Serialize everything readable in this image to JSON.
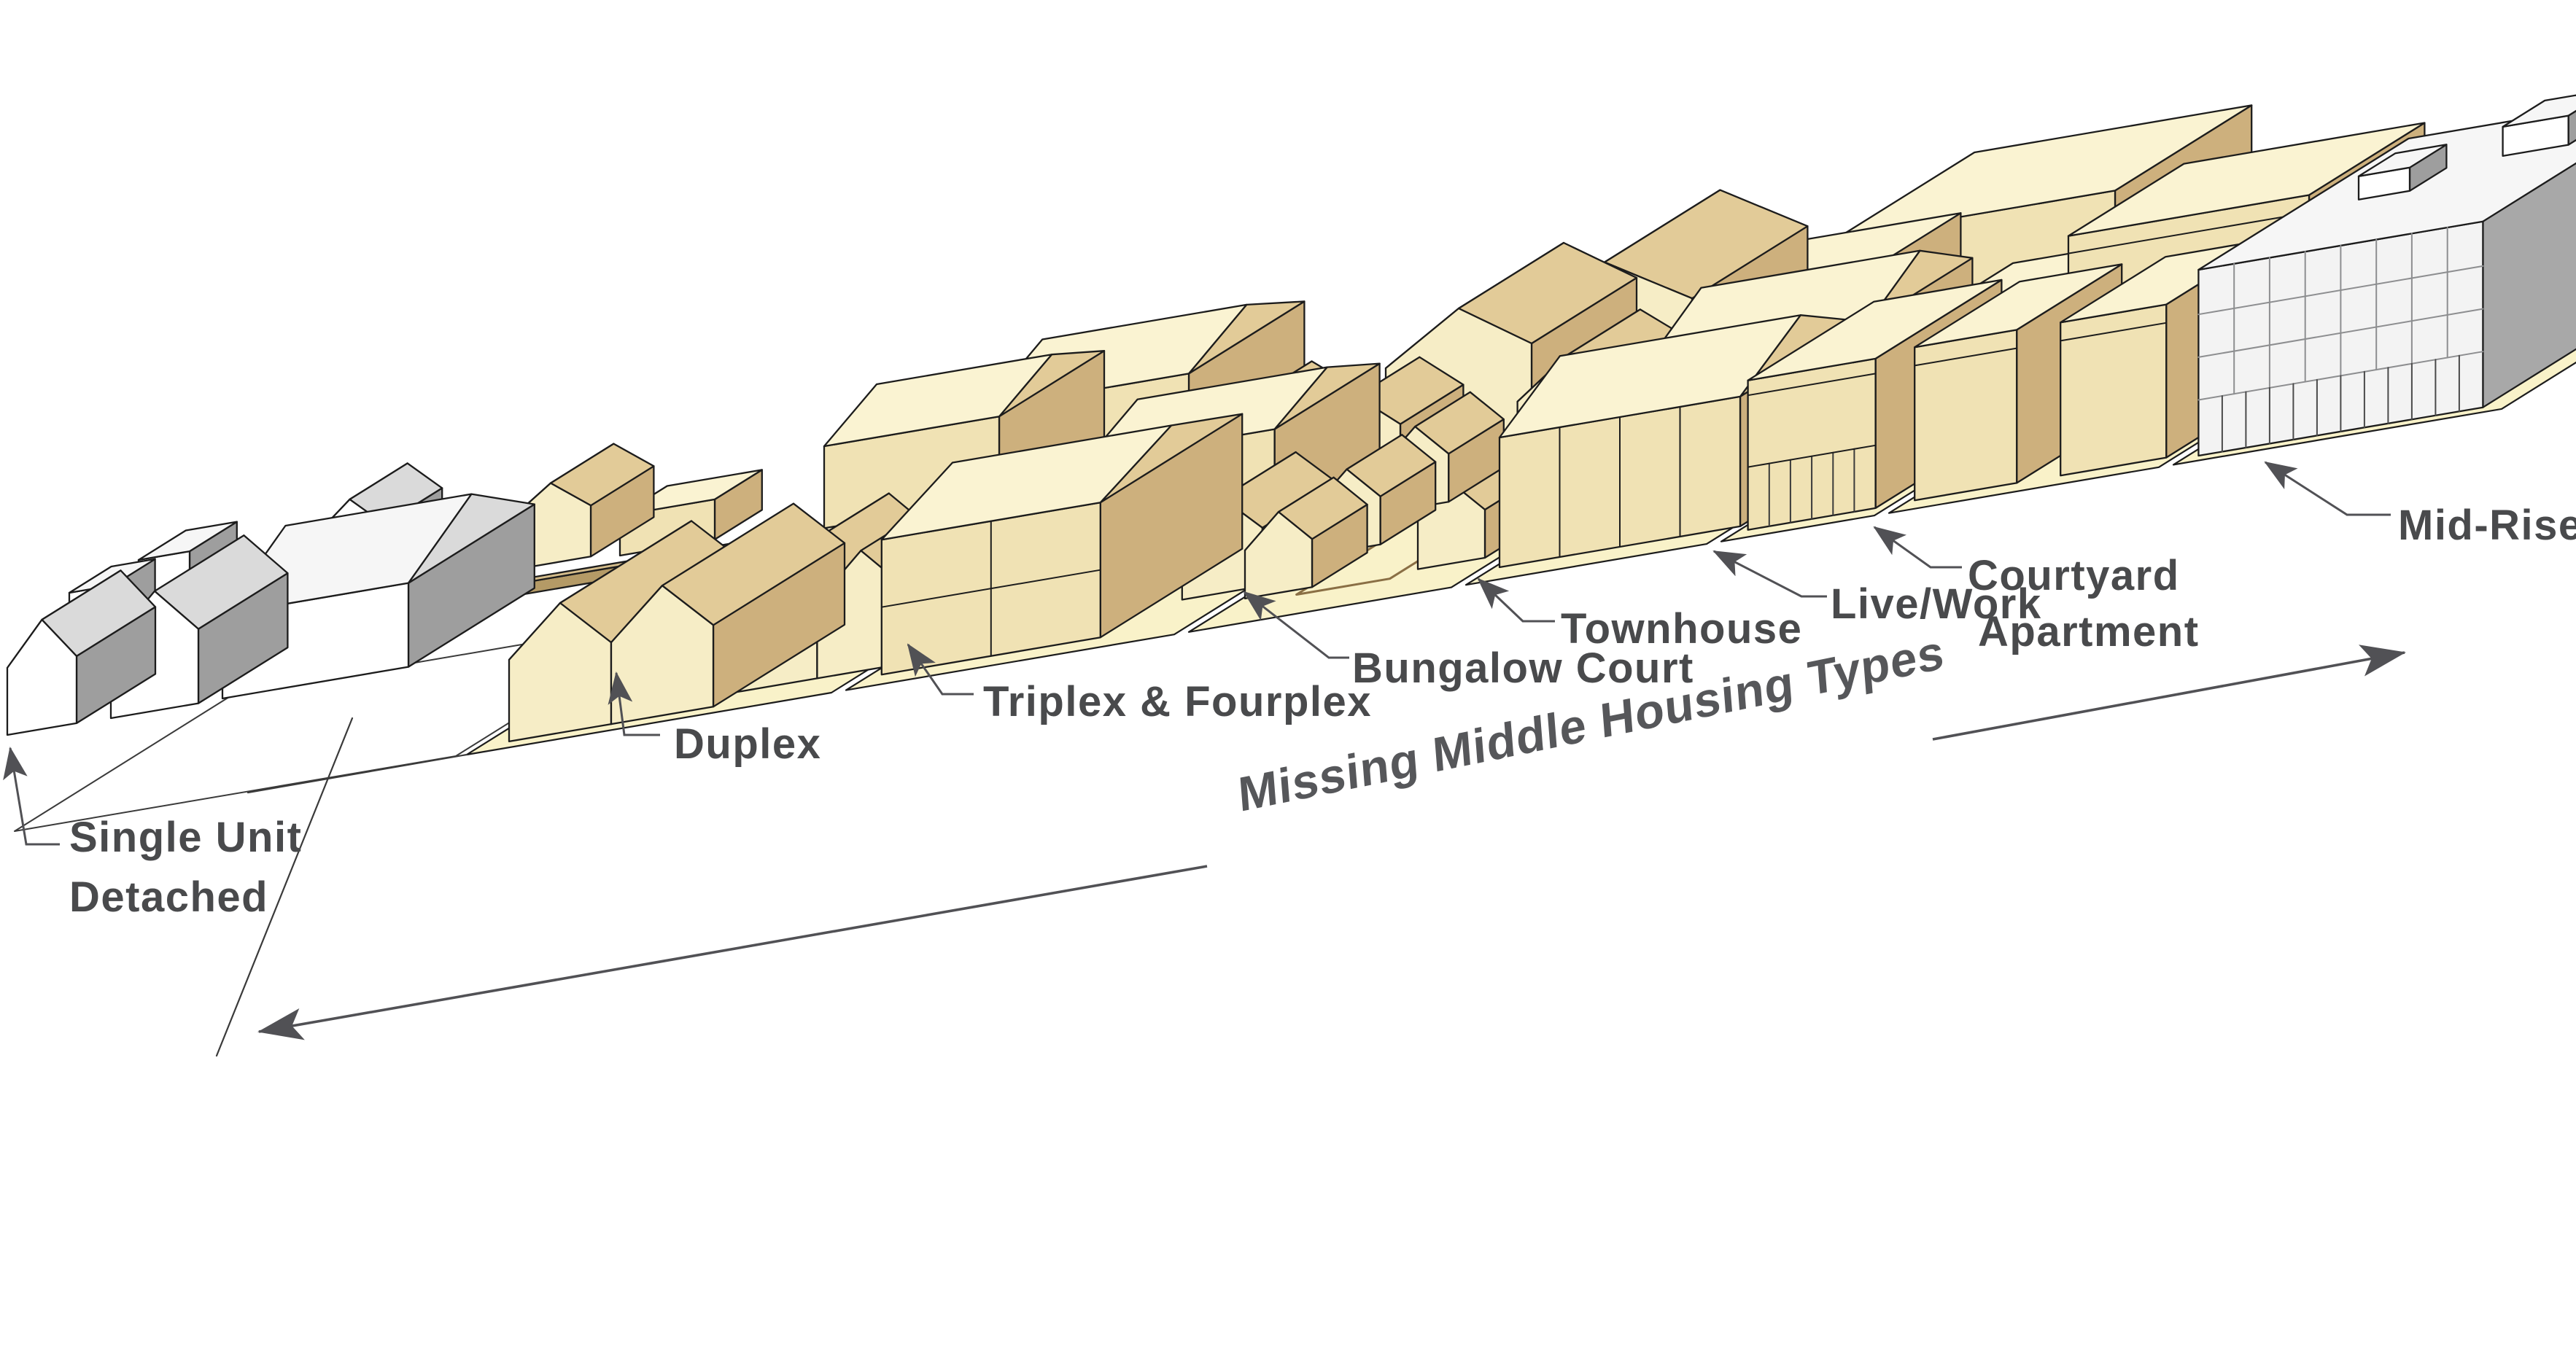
{
  "diagram": {
    "title": "Missing Middle Housing Types",
    "labels": {
      "single_unit_line1": "Single Unit",
      "single_unit_line2": "Detached",
      "duplex": "Duplex",
      "triplex": "Triplex & Fourplex",
      "bungalow": "Bungalow Court",
      "townhouse": "Townhouse",
      "livework": "Live/Work",
      "courtyard_line1": "Courtyard",
      "courtyard_line2": "Apartment",
      "midrise": "Mid-Rise"
    },
    "colors": {
      "ground": "#F9F2C9",
      "beige_front": "#F0E2B4",
      "beige_front_lit": "#F6EDC6",
      "beige_side": "#CDB07D",
      "beige_top": "#FAF3D2",
      "beige_roof_shade": "#E2CB98",
      "beige_dark": "#9F8050",
      "white_front": "#FFFFFF",
      "white_side": "#9E9E9E",
      "white_top": "#F6F6F6",
      "white_roof_shade": "#DADADA",
      "midrise_front": "#F3F3F3",
      "midrise_side": "#A8A8A8",
      "grid_line": "#8D8E90",
      "outline": "#1C1C1C",
      "label_text": "#494A4C",
      "title_text": "#56575A",
      "arrow": "#515155"
    }
  }
}
